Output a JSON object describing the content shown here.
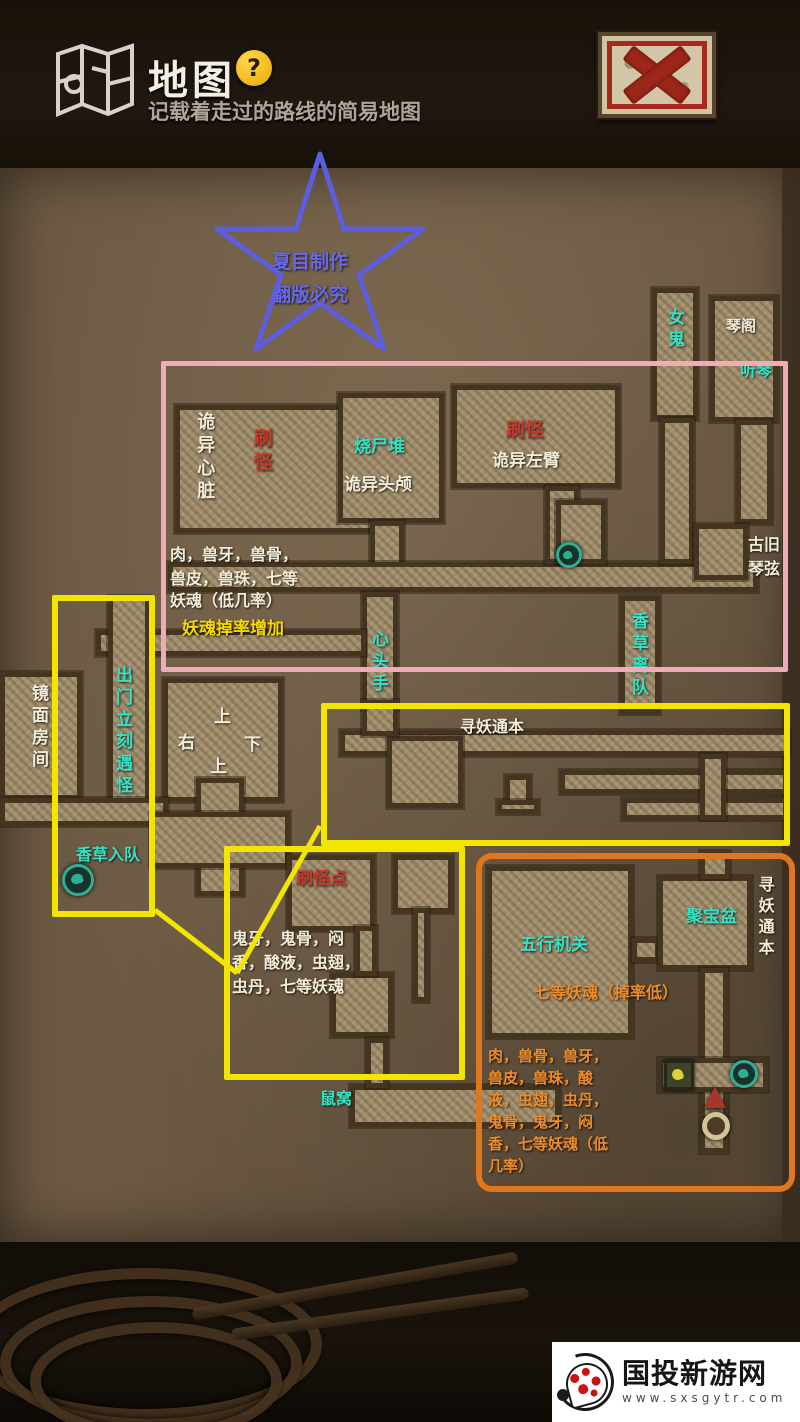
{
  "header": {
    "title": "地图",
    "help_label": "?",
    "subtitle": "记载着走过的路线的简易地图"
  },
  "close_button": {
    "name": "close-map"
  },
  "watermark": {
    "site": "国投新游网",
    "url": "www.sxsgytr.com"
  },
  "colors": {
    "white": "#f2ecd8",
    "cyan": "#36e2c6",
    "red": "#c53a2c",
    "yellow": "#f6d800",
    "orange": "#ef8c2a",
    "blue": "#6868e8",
    "pink_box": "#f0aab8",
    "yellow_box": "#f2e600",
    "orange_box": "#e0761e"
  },
  "star": {
    "points": "320,154 344,229 423,229 359,275 384,349 320,303 256,349 281,275 217,229 296,229",
    "color": "#5d5de0"
  },
  "map": {
    "rects": [
      {
        "x": 175,
        "y": 405,
        "w": 212,
        "h": 128
      },
      {
        "x": 338,
        "y": 393,
        "w": 106,
        "h": 130
      },
      {
        "x": 452,
        "y": 385,
        "w": 168,
        "h": 103
      },
      {
        "x": 370,
        "y": 521,
        "w": 34,
        "h": 48
      },
      {
        "x": 168,
        "y": 562,
        "w": 590,
        "h": 30
      },
      {
        "x": 545,
        "y": 486,
        "w": 34,
        "h": 78
      },
      {
        "x": 652,
        "y": 288,
        "w": 46,
        "h": 132
      },
      {
        "x": 710,
        "y": 296,
        "w": 68,
        "h": 126
      },
      {
        "x": 660,
        "y": 418,
        "w": 34,
        "h": 146
      },
      {
        "x": 736,
        "y": 420,
        "w": 36,
        "h": 104
      },
      {
        "x": 694,
        "y": 524,
        "w": 54,
        "h": 56
      },
      {
        "x": 556,
        "y": 500,
        "w": 50,
        "h": 64
      },
      {
        "x": 362,
        "y": 592,
        "w": 36,
        "h": 118
      },
      {
        "x": 96,
        "y": 630,
        "w": 270,
        "h": 26
      },
      {
        "x": 108,
        "y": 596,
        "w": 42,
        "h": 212
      },
      {
        "x": 0,
        "y": 672,
        "w": 82,
        "h": 128
      },
      {
        "x": 163,
        "y": 678,
        "w": 120,
        "h": 124
      },
      {
        "x": 0,
        "y": 798,
        "w": 168,
        "h": 28
      },
      {
        "x": 196,
        "y": 778,
        "w": 48,
        "h": 118
      },
      {
        "x": 150,
        "y": 812,
        "w": 140,
        "h": 56
      },
      {
        "x": 620,
        "y": 596,
        "w": 40,
        "h": 118
      },
      {
        "x": 340,
        "y": 730,
        "w": 450,
        "h": 26
      },
      {
        "x": 387,
        "y": 736,
        "w": 76,
        "h": 72
      },
      {
        "x": 560,
        "y": 770,
        "w": 228,
        "h": 24
      },
      {
        "x": 622,
        "y": 798,
        "w": 166,
        "h": 22
      },
      {
        "x": 700,
        "y": 754,
        "w": 26,
        "h": 66
      },
      {
        "x": 505,
        "y": 775,
        "w": 26,
        "h": 32
      },
      {
        "x": 497,
        "y": 800,
        "w": 42,
        "h": 14
      },
      {
        "x": 362,
        "y": 700,
        "w": 36,
        "h": 36
      },
      {
        "x": 287,
        "y": 855,
        "w": 88,
        "h": 76
      },
      {
        "x": 393,
        "y": 855,
        "w": 60,
        "h": 58
      },
      {
        "x": 331,
        "y": 973,
        "w": 62,
        "h": 64
      },
      {
        "x": 355,
        "y": 926,
        "w": 22,
        "h": 50
      },
      {
        "x": 413,
        "y": 908,
        "w": 16,
        "h": 94
      },
      {
        "x": 350,
        "y": 1085,
        "w": 210,
        "h": 42
      },
      {
        "x": 366,
        "y": 1038,
        "w": 22,
        "h": 50
      },
      {
        "x": 487,
        "y": 866,
        "w": 146,
        "h": 172
      },
      {
        "x": 632,
        "y": 938,
        "w": 28,
        "h": 24
      },
      {
        "x": 658,
        "y": 876,
        "w": 94,
        "h": 94
      },
      {
        "x": 700,
        "y": 851,
        "w": 30,
        "h": 28
      },
      {
        "x": 700,
        "y": 968,
        "w": 28,
        "h": 185
      },
      {
        "x": 658,
        "y": 1058,
        "w": 110,
        "h": 34
      }
    ],
    "labels": [
      {
        "t": "夏目制作",
        "x": 272,
        "y": 250,
        "c": "blue",
        "s": 19,
        "name": "star-text-line1"
      },
      {
        "t": "翻版必究",
        "x": 272,
        "y": 283,
        "c": "blue",
        "s": 19,
        "name": "star-text-line2"
      },
      {
        "t": "诡异心脏",
        "x": 192,
        "y": 412,
        "c": "white",
        "s": 18,
        "v": 1,
        "name": "room-label-strange-heart"
      },
      {
        "t": "刷怪",
        "x": 248,
        "y": 428,
        "c": "red",
        "s": 19,
        "v": 1,
        "name": "note-monster-spawn-1"
      },
      {
        "t": "烧尸堆",
        "x": 354,
        "y": 436,
        "c": "cyan",
        "s": 17,
        "name": "room-label-corpse-pile"
      },
      {
        "t": "诡异头颅",
        "x": 344,
        "y": 474,
        "c": "white",
        "s": 17,
        "name": "room-label-strange-skull"
      },
      {
        "t": "刷怪",
        "x": 506,
        "y": 418,
        "c": "red",
        "s": 19,
        "name": "note-monster-spawn-2"
      },
      {
        "t": "诡异左臂",
        "x": 492,
        "y": 450,
        "c": "white",
        "s": 17,
        "name": "room-label-strange-left-arm"
      },
      {
        "t": "女鬼",
        "x": 662,
        "y": 308,
        "c": "cyan",
        "s": 17,
        "v": 1,
        "name": "room-label-female-ghost"
      },
      {
        "t": "琴阁",
        "x": 726,
        "y": 316,
        "c": "white",
        "s": 15,
        "name": "room-label-qin-pavilion"
      },
      {
        "t": "听琴",
        "x": 740,
        "y": 360,
        "c": "cyan",
        "s": 16,
        "name": "note-listen-qin"
      },
      {
        "t": "古旧",
        "x": 748,
        "y": 534,
        "c": "white",
        "s": 16,
        "name": "item-old-qin-string-1"
      },
      {
        "t": "琴弦",
        "x": 748,
        "y": 558,
        "c": "white",
        "s": 16,
        "name": "item-old-qin-string-2"
      },
      {
        "t": "肉，兽牙，兽骨，",
        "x": 170,
        "y": 544,
        "c": "white",
        "s": 16,
        "name": "drops-list-pink-1"
      },
      {
        "t": "兽皮，兽珠，七等",
        "x": 170,
        "y": 568,
        "c": "white",
        "s": 16,
        "name": "drops-list-pink-2"
      },
      {
        "t": "妖魂（低几率）",
        "x": 170,
        "y": 590,
        "c": "white",
        "s": 16,
        "name": "drops-list-pink-3"
      },
      {
        "t": "妖魂掉率增加",
        "x": 182,
        "y": 618,
        "c": "yellow",
        "s": 17,
        "name": "note-soul-drop-rate-up"
      },
      {
        "t": "心头手",
        "x": 366,
        "y": 630,
        "c": "cyan",
        "s": 17,
        "v": 1,
        "name": "room-label-heart-head-hand"
      },
      {
        "t": "香草离队",
        "x": 626,
        "y": 612,
        "c": "cyan",
        "s": 17,
        "v": 1,
        "name": "note-xiangcao-leaves-party"
      },
      {
        "t": "镜面房间",
        "x": 26,
        "y": 684,
        "c": "white",
        "s": 17,
        "v": 1,
        "name": "room-label-mirror-room"
      },
      {
        "t": "出门立刻遇怪",
        "x": 110,
        "y": 666,
        "c": "cyan",
        "s": 17,
        "v": 1,
        "name": "note-monster-on-exit"
      },
      {
        "t": "上",
        "x": 214,
        "y": 706,
        "c": "white",
        "s": 17,
        "name": "direction-up-1"
      },
      {
        "t": "右",
        "x": 178,
        "y": 732,
        "c": "white",
        "s": 17,
        "name": "direction-right"
      },
      {
        "t": "下",
        "x": 244,
        "y": 734,
        "c": "white",
        "s": 17,
        "name": "direction-down"
      },
      {
        "t": "上",
        "x": 210,
        "y": 756,
        "c": "white",
        "s": 17,
        "name": "direction-up-2"
      },
      {
        "t": "香草入队",
        "x": 76,
        "y": 844,
        "c": "cyan",
        "s": 16,
        "name": "note-xiangcao-joins-party"
      },
      {
        "t": "寻妖通本",
        "x": 460,
        "y": 716,
        "c": "white",
        "s": 16,
        "name": "note-seek-demon-book-1"
      },
      {
        "t": "刷怪点",
        "x": 296,
        "y": 868,
        "c": "red",
        "s": 17,
        "name": "note-monster-spawn-3"
      },
      {
        "t": "鬼牙，鬼骨，闷",
        "x": 232,
        "y": 928,
        "c": "white",
        "s": 16,
        "name": "drops-list-yellow-1"
      },
      {
        "t": "香，酸液，虫翅，",
        "x": 232,
        "y": 952,
        "c": "white",
        "s": 16,
        "name": "drops-list-yellow-2"
      },
      {
        "t": "虫丹，七等妖魂",
        "x": 232,
        "y": 976,
        "c": "white",
        "s": 16,
        "name": "drops-list-yellow-3"
      },
      {
        "t": "五行机关",
        "x": 520,
        "y": 934,
        "c": "cyan",
        "s": 17,
        "name": "room-label-five-element-mechanism"
      },
      {
        "t": "聚宝盆",
        "x": 686,
        "y": 906,
        "c": "cyan",
        "s": 17,
        "name": "room-label-treasure-bowl"
      },
      {
        "t": "寻妖通本",
        "x": 754,
        "y": 876,
        "c": "white",
        "s": 16,
        "v": 1,
        "name": "note-seek-demon-book-2"
      },
      {
        "t": "七等妖魂（掉率低）",
        "x": 534,
        "y": 982,
        "c": "orange",
        "s": 16,
        "name": "note-soul-low-drop"
      },
      {
        "t": "肉，兽骨，兽牙，",
        "x": 488,
        "y": 1046,
        "c": "orange",
        "s": 15,
        "name": "drops-list-orange-1"
      },
      {
        "t": "兽皮，兽珠，酸",
        "x": 488,
        "y": 1068,
        "c": "orange",
        "s": 15,
        "name": "drops-list-orange-2"
      },
      {
        "t": "液，虫翅，虫丹，",
        "x": 488,
        "y": 1090,
        "c": "orange",
        "s": 15,
        "name": "drops-list-orange-3"
      },
      {
        "t": "鬼骨，鬼牙，闷",
        "x": 488,
        "y": 1112,
        "c": "orange",
        "s": 15,
        "name": "drops-list-orange-4"
      },
      {
        "t": "香，七等妖魂（低",
        "x": 488,
        "y": 1134,
        "c": "orange",
        "s": 15,
        "name": "drops-list-orange-5"
      },
      {
        "t": "几率）",
        "x": 488,
        "y": 1156,
        "c": "orange",
        "s": 15,
        "name": "drops-list-orange-6"
      },
      {
        "t": "鼠窝",
        "x": 320,
        "y": 1088,
        "c": "cyan",
        "s": 16,
        "name": "room-label-rat-nest"
      }
    ],
    "icons": [
      {
        "type": "circle-teal",
        "x": 556,
        "y": 542,
        "d": 26,
        "name": "footprint-marker-icon"
      },
      {
        "type": "circle-teal",
        "x": 62,
        "y": 864,
        "d": 32,
        "name": "footprint-marker-icon"
      },
      {
        "type": "square-foot",
        "x": 664,
        "y": 1060,
        "d": 30,
        "name": "footprint-tile-icon"
      },
      {
        "type": "circle-teal",
        "x": 730,
        "y": 1060,
        "d": 28,
        "name": "footprint-marker-icon"
      },
      {
        "type": "arrow-red",
        "x": 704,
        "y": 1086,
        "d": 22,
        "name": "up-arrow-marker-icon"
      },
      {
        "type": "ring",
        "x": 702,
        "y": 1112,
        "d": 28,
        "name": "well-marker-icon"
      }
    ]
  },
  "overlays": {
    "boxes": [
      {
        "x": 161,
        "y": 361,
        "w": 627,
        "h": 311,
        "c": "pink_box",
        "bw": 5,
        "r": 2,
        "name": "highlight-box-pink"
      },
      {
        "x": 52,
        "y": 595,
        "w": 103,
        "h": 322,
        "c": "yellow_box",
        "bw": 6,
        "r": 2,
        "name": "highlight-box-yellow-left"
      },
      {
        "x": 321,
        "y": 703,
        "w": 469,
        "h": 143,
        "c": "yellow_box",
        "bw": 6,
        "r": 2,
        "name": "highlight-box-yellow-wide"
      },
      {
        "x": 224,
        "y": 846,
        "w": 241,
        "h": 234,
        "c": "yellow_box",
        "bw": 6,
        "r": 2,
        "name": "highlight-box-yellow-lower"
      },
      {
        "x": 476,
        "y": 853,
        "w": 319,
        "h": 339,
        "c": "orange_box",
        "bw": 6,
        "r": 16,
        "name": "highlight-box-orange"
      }
    ],
    "lines": [
      {
        "pts": "155,910 237,973",
        "c": "yellow_box",
        "w": 5,
        "name": "connector-line-1"
      },
      {
        "pts": "237,973 320,826",
        "c": "yellow_box",
        "w": 5,
        "name": "connector-line-2"
      }
    ]
  }
}
